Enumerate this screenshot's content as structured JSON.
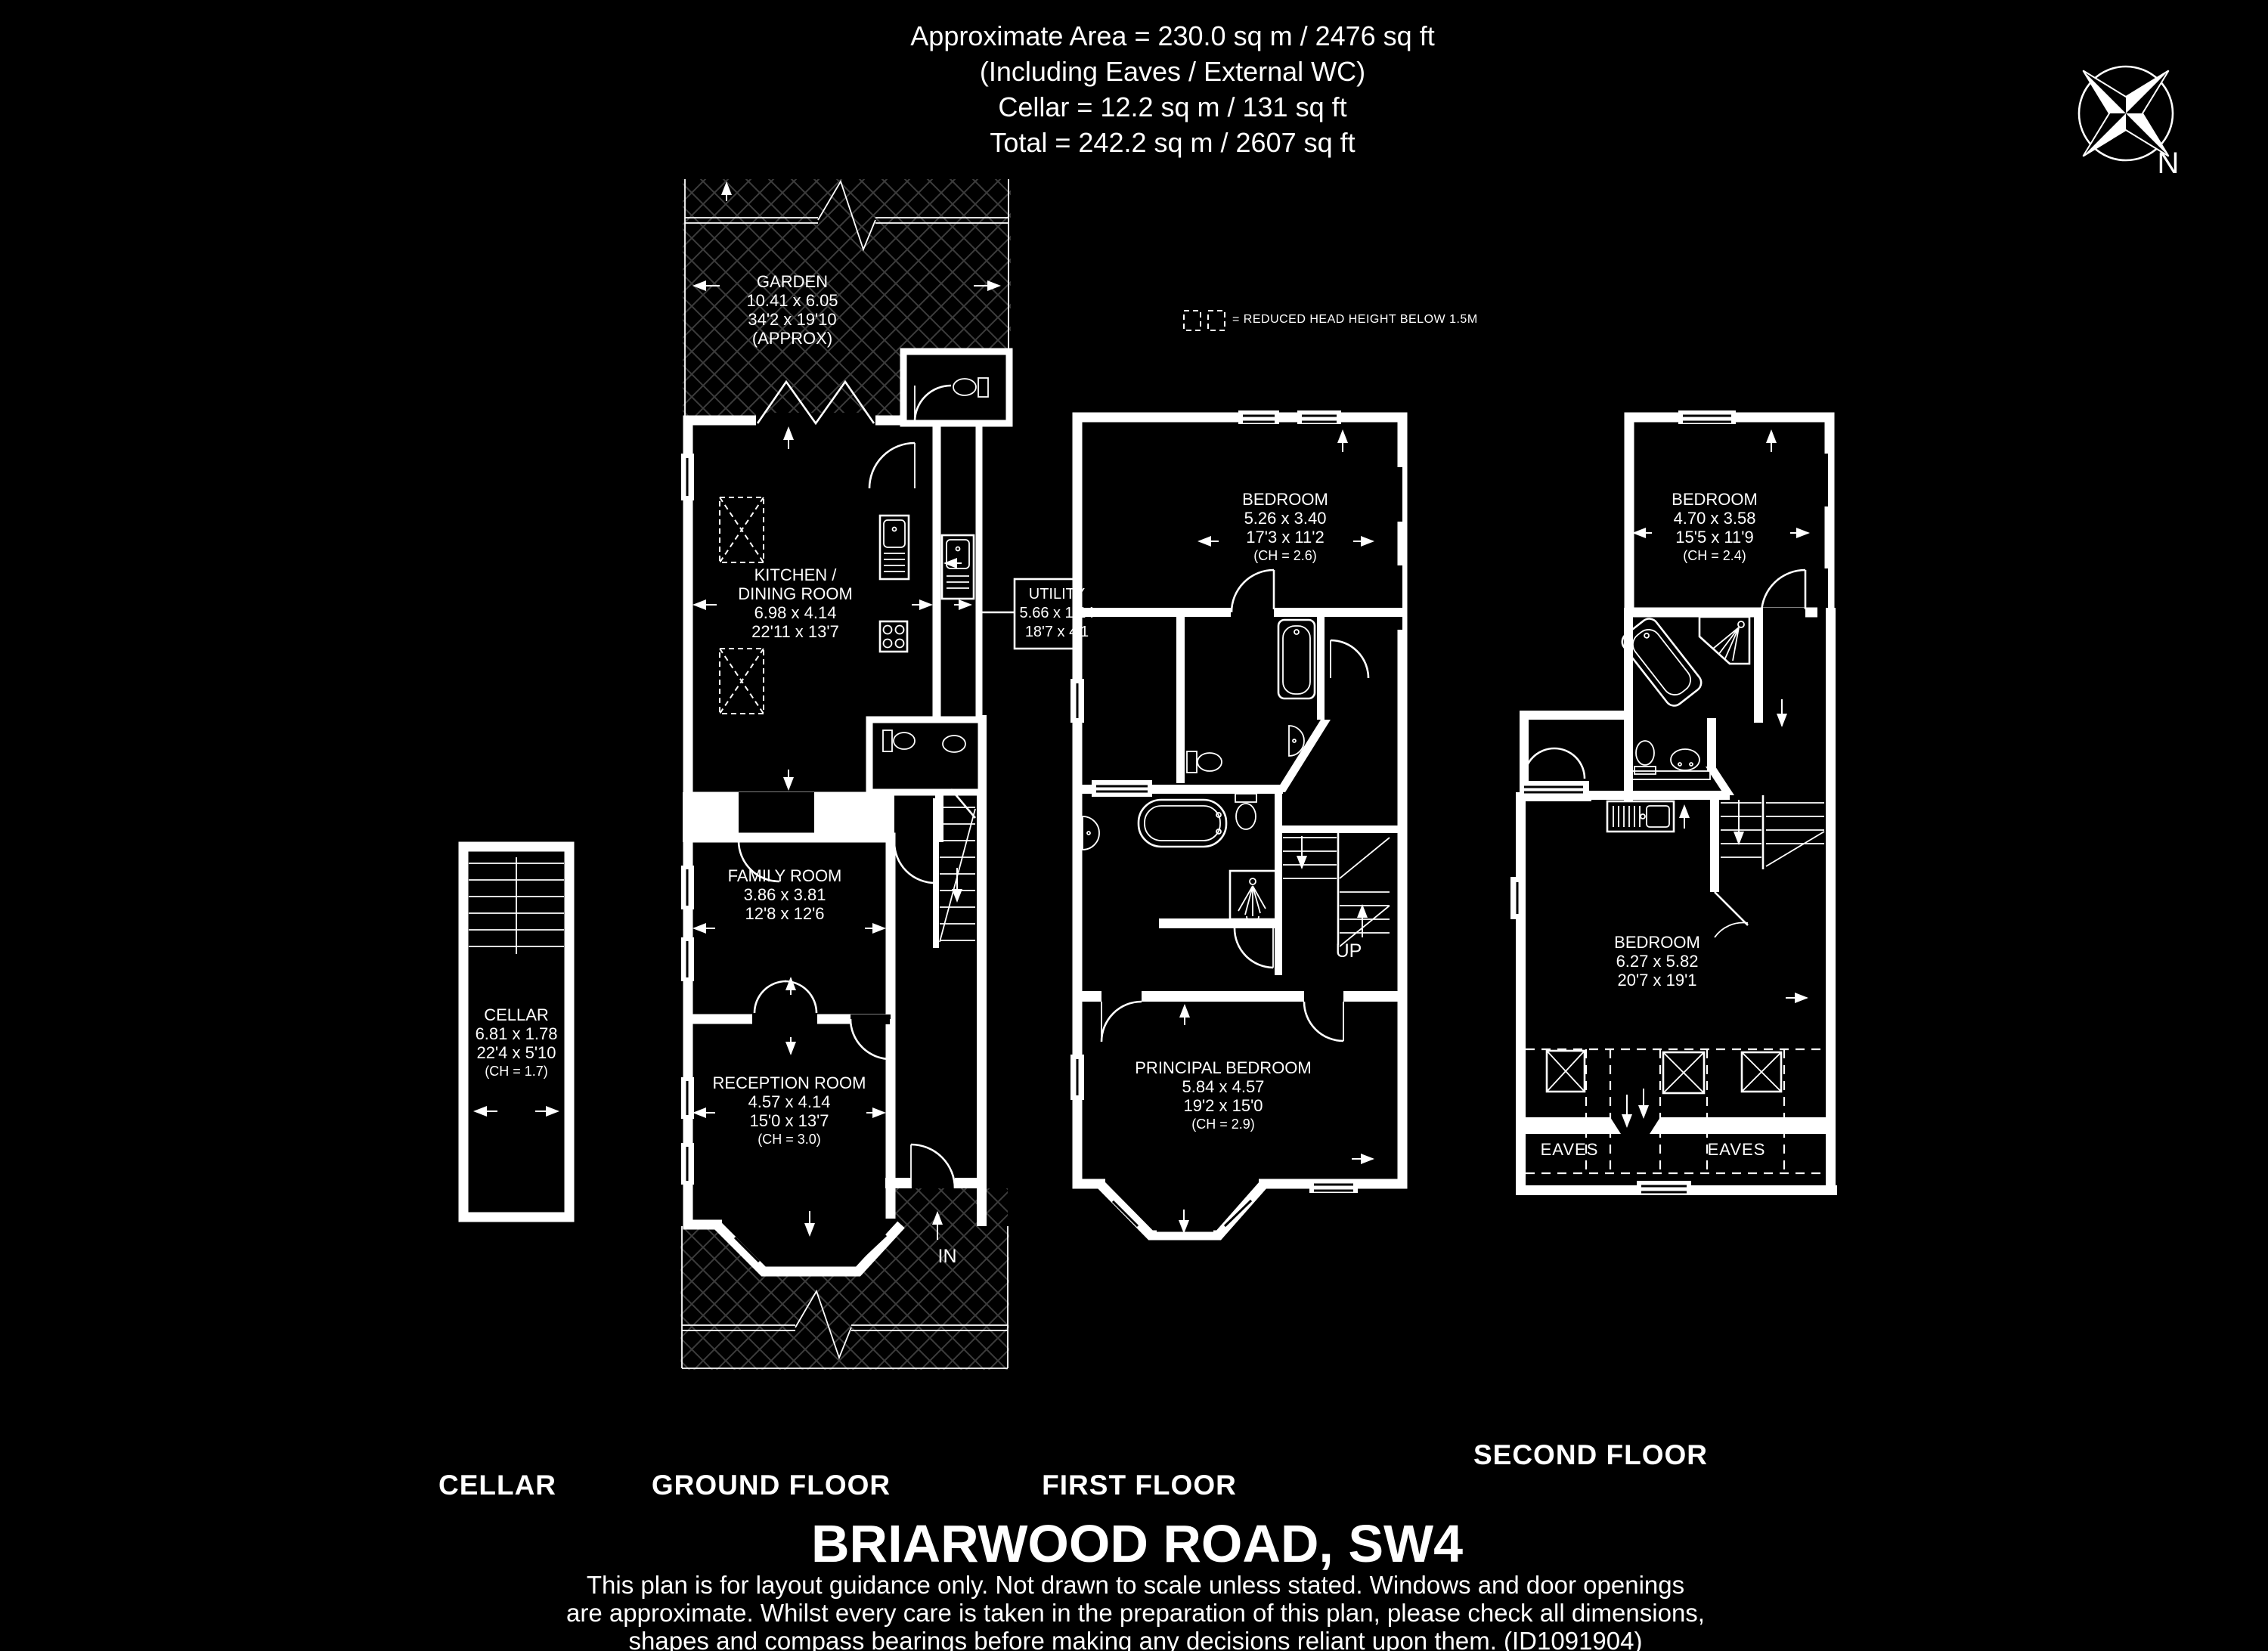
{
  "header": {
    "line1": "Approximate Area = 230.0 sq m / 2476 sq ft",
    "line2": "(Including Eaves / External WC)",
    "line3": "Cellar = 12.2 sq m / 131 sq ft",
    "line4": "Total = 242.2 sq m / 2607 sq ft"
  },
  "compass": {
    "north_label": "N"
  },
  "legend": {
    "text": "= REDUCED HEAD HEIGHT BELOW 1.5M"
  },
  "rooms": {
    "garden": {
      "lines": [
        "GARDEN",
        "10.41 x 6.05",
        "34'2 x 19'10",
        "(APPROX)"
      ]
    },
    "kitchen": {
      "lines": [
        "KITCHEN /",
        "DINING ROOM",
        "6.98 x 4.14",
        "22'11 x 13'7"
      ]
    },
    "utility": {
      "lines": [
        "UTILITY",
        "5.66 x 1.24",
        "18'7 x 4'1"
      ]
    },
    "family_room": {
      "lines": [
        "FAMILY ROOM",
        "3.86 x 3.81",
        "12'8 x 12'6"
      ]
    },
    "reception_room": {
      "lines": [
        "RECEPTION ROOM",
        "4.57 x 4.14",
        "15'0 x 13'7"
      ],
      "ch": "(CH = 3.0)"
    },
    "cellar": {
      "lines": [
        "CELLAR",
        "6.81 x 1.78",
        "22'4 x 5'10"
      ],
      "ch": "(CH = 1.7)"
    },
    "bedroom_first": {
      "lines": [
        "BEDROOM",
        "5.26 x 3.40",
        "17'3 x 11'2"
      ],
      "ch": "(CH = 2.6)"
    },
    "principal_bedroom": {
      "lines": [
        "PRINCIPAL BEDROOM",
        "5.84 x 4.57",
        "19'2 x 15'0"
      ],
      "ch": "(CH = 2.9)"
    },
    "bedroom_second_front": {
      "lines": [
        "BEDROOM",
        "4.70 x 3.58",
        "15'5 x 11'9"
      ],
      "ch": "(CH = 2.4)"
    },
    "bedroom_second_rear": {
      "lines": [
        "BEDROOM",
        "6.27 x 5.82",
        "20'7 x 19'1"
      ]
    }
  },
  "annotations": {
    "up": "UP",
    "in": "IN",
    "eaves_left": "EAVES",
    "eaves_right": "EAVES"
  },
  "floor_labels": {
    "cellar": "CELLAR",
    "ground": "GROUND FLOOR",
    "first": "FIRST FLOOR",
    "second": "SECOND FLOOR"
  },
  "title": "BRIARWOOD ROAD, SW4",
  "disclaimer": {
    "line1": "This plan is for layout guidance only. Not drawn to scale unless stated. Windows and door openings",
    "line2": "are approximate. Whilst every care is taken in the preparation of this plan, please check all dimensions,",
    "line3": "shapes and compass bearings before making any decisions reliant upon them. (ID1091904)"
  },
  "colors": {
    "background": "#000000",
    "lines": "#ffffff",
    "hatch": "#3c3c3c"
  }
}
